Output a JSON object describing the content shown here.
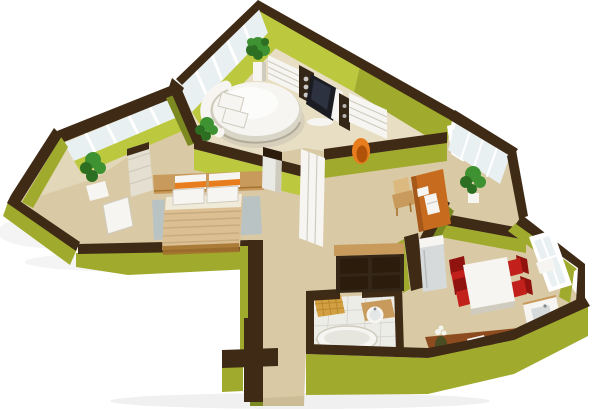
{
  "scene": {
    "type": "3d-floor-plan-render",
    "description": "3D cutaway floor plan of an apartment: olive green walls with dark brown wall tops, beige floors, a lounge with round bed and TV media wall, a bedroom with double bed, hallway with wardrobes, a study corner with desk, kitchen-dining with white table and red chairs, a bathroom with tub, and two glazed balconies.",
    "background": "#ffffff",
    "rooms": [
      "lounge-with-round-bed",
      "bedroom",
      "hallway",
      "study-corner",
      "kitchen-dining",
      "bathroom",
      "left-balcony",
      "right-balcony"
    ],
    "furniture": [
      "round-bed",
      "tv-panel",
      "media-shelves",
      "cd-tower",
      "speaker",
      "egg-chair",
      "potted-plant",
      "double-bed",
      "wardrobe",
      "bedside-cabinet",
      "hall-pillar",
      "hall-wardrobe",
      "shelf-cabinet",
      "writing-desk",
      "desk-chair",
      "laptop",
      "fridge",
      "dining-table",
      "red-chair",
      "corner-sink-unit",
      "kitchen-counter",
      "hob",
      "vase",
      "bathtub",
      "washbasin"
    ]
  },
  "colors": {
    "wall_top": "#3e2a15",
    "wall_top_dark": "#2b1c0c",
    "olive": "#a0ab2d",
    "olive_bright": "#bcc83e",
    "olive_dark": "#7c8820",
    "floor": "#d9caa5",
    "floor_light": "#e9e0c6",
    "floor_dark": "#c2b088",
    "glass": "#e9f0f2",
    "white": "#ffffff",
    "furn_white": "#f6f5f1",
    "furn_shadow": "#cfccbf",
    "wood": "#c89a5c",
    "wood_dark": "#a5732e",
    "blanket": "#dcc094",
    "orange": "#e87d1e",
    "desk": "#c76c1e",
    "red": "#c2201a",
    "red_dark": "#911310",
    "counter": "#8c4c20",
    "counter_front": "#6e3a16",
    "cabinet": "#342718",
    "screen": "#1b1c22",
    "metal": "#d6dadb",
    "rug": "#b3c2c9",
    "plant": "#3f9231",
    "plant_dark": "#2c6f22",
    "tile": "#edede8",
    "tile_grid": "#d8d7cf",
    "mosaic": "#d3a041",
    "fold_line": "#c9ab7e"
  }
}
